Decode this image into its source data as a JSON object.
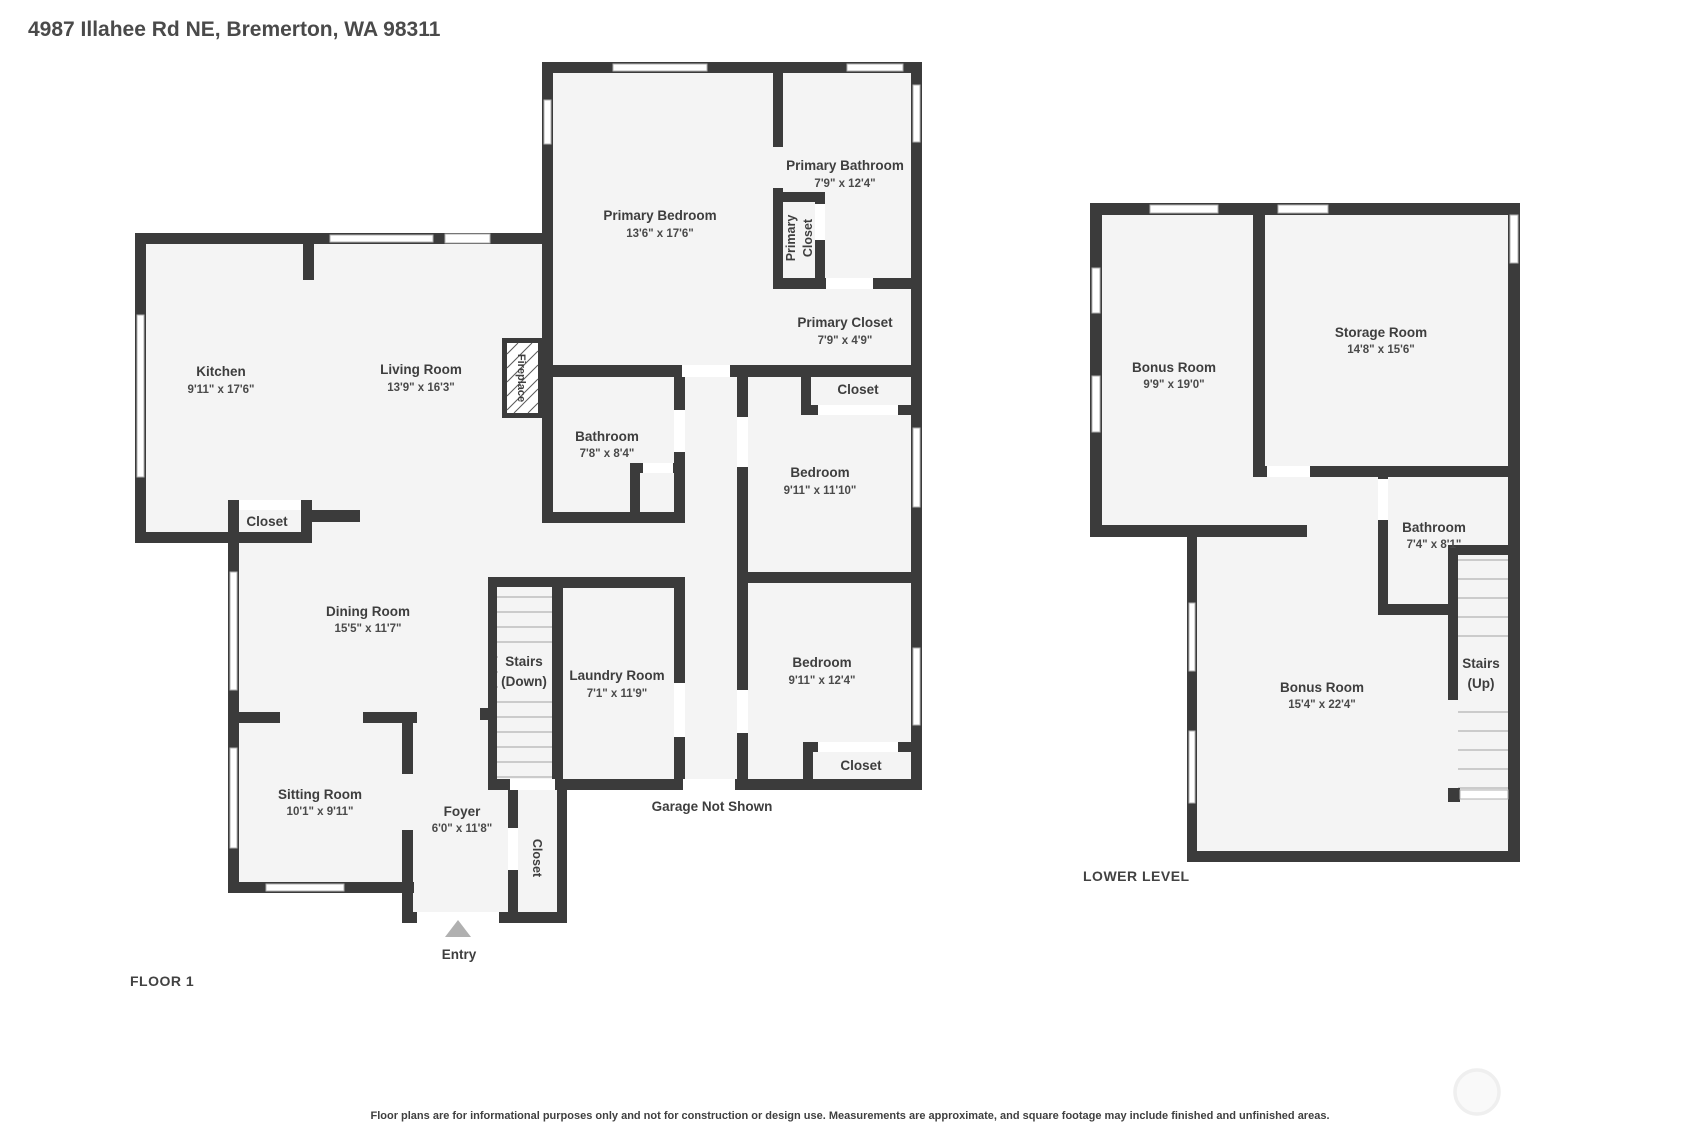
{
  "page": {
    "title": "4987 Illahee Rd NE, Bremerton, WA 98311",
    "disclaimer": "Floor plans are for informational purposes only and not for construction or design use. Measurements are approximate, and square footage may include finished and unfinished areas."
  },
  "colors": {
    "wall": "#3b3b3b",
    "floor": "#f4f4f4",
    "text": "#3e3e3e"
  },
  "floor1": {
    "label": "FLOOR 1",
    "garage_note": "Garage Not Shown",
    "entry": "Entry",
    "stairs": {
      "line1": "Stairs",
      "line2": "(Down)"
    },
    "fireplace": "Fireplace",
    "rooms": {
      "primary_bedroom": {
        "name": "Primary Bedroom",
        "dims": "13'6\" x 17'6\""
      },
      "primary_bathroom": {
        "name": "Primary Bathroom",
        "dims": "7'9\" x 12'4\""
      },
      "primary_closet_small": {
        "line1": "Primary",
        "line2": "Closet"
      },
      "primary_closet": {
        "name": "Primary Closet",
        "dims": "7'9\" x 4'9\""
      },
      "kitchen": {
        "name": "Kitchen",
        "dims": "9'11\" x 17'6\""
      },
      "living": {
        "name": "Living Room",
        "dims": "13'9\" x 16'3\""
      },
      "bathroom": {
        "name": "Bathroom",
        "dims": "7'8\" x 8'4\""
      },
      "closet_bed1": {
        "name": "Closet"
      },
      "bedroom1": {
        "name": "Bedroom",
        "dims": "9'11\" x 11'10\""
      },
      "bedroom2": {
        "name": "Bedroom",
        "dims": "9'11\" x 12'4\""
      },
      "closet_bed2": {
        "name": "Closet"
      },
      "closet_kitchen": {
        "name": "Closet"
      },
      "dining": {
        "name": "Dining Room",
        "dims": "15'5\" x 11'7\""
      },
      "sitting": {
        "name": "Sitting Room",
        "dims": "10'1\" x 9'11\""
      },
      "foyer": {
        "name": "Foyer",
        "dims": "6'0\" x 11'8\""
      },
      "laundry": {
        "name": "Laundry Room",
        "dims": "7'1\" x 11'9\""
      },
      "closet_foyer": {
        "name": "Closet"
      }
    }
  },
  "lower": {
    "label": "LOWER LEVEL",
    "stairs": {
      "line1": "Stairs",
      "line2": "(Up)"
    },
    "rooms": {
      "bonus1": {
        "name": "Bonus Room",
        "dims": "9'9\" x 19'0\""
      },
      "storage": {
        "name": "Storage Room",
        "dims": "14'8\" x 15'6\""
      },
      "bathroom": {
        "name": "Bathroom",
        "dims": "7'4\" x 8'1\""
      },
      "bonus2": {
        "name": "Bonus Room",
        "dims": "15'4\" x 22'4\""
      }
    }
  }
}
